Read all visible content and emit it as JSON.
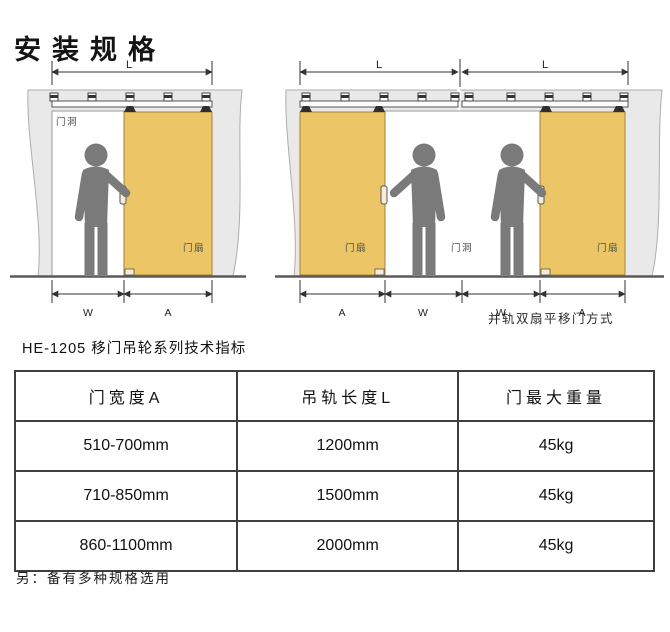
{
  "page": {
    "title": "安装规格"
  },
  "diagram_single": {
    "track_length_label": "L",
    "opening_width_label": "W",
    "door_width_label": "A",
    "opening_label": "门洞",
    "door_label": "门扇"
  },
  "diagram_double": {
    "track_length_labels": [
      "L",
      "L"
    ],
    "bottom_dim_labels": [
      "A",
      "W",
      "W",
      "A"
    ],
    "door_labels": [
      "门扇",
      "门扇"
    ],
    "opening_label": "门洞",
    "caption": "并轨双扇平移门方式"
  },
  "table": {
    "title": "HE-1205 移门吊轮系列技术指标",
    "headers": [
      "门宽度A",
      "吊轨长度L",
      "门最大重量"
    ],
    "rows": [
      [
        "510-700mm",
        "1200mm",
        "45kg"
      ],
      [
        "710-850mm",
        "1500mm",
        "45kg"
      ],
      [
        "860-1100mm",
        "2000mm",
        "45kg"
      ]
    ]
  },
  "note": "另：备有多种规格选用",
  "colors": {
    "door": "#ecc566",
    "wall": "#e9e9e9",
    "figure": "#7a7a7a",
    "line": "#333333"
  }
}
